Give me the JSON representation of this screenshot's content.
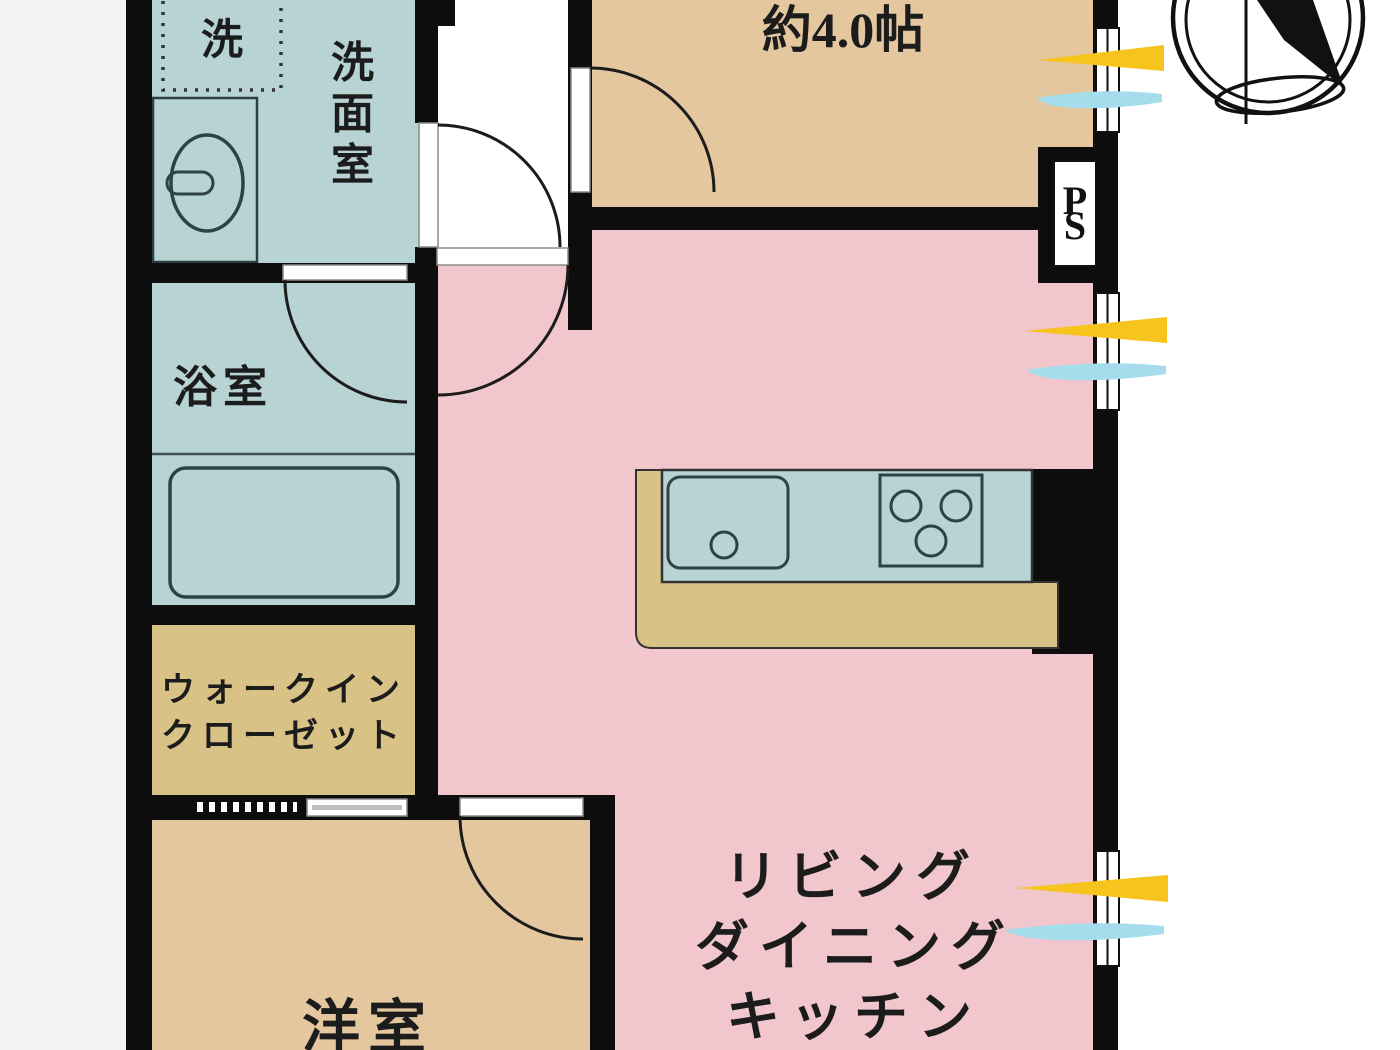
{
  "floor_plan": {
    "rooms": {
      "washroom": {
        "label": "洗面室",
        "washer_label": "洗"
      },
      "bathroom": {
        "label": "浴室"
      },
      "walk_in_closet": {
        "label_line1": "ウォークイン",
        "label_line2": "クローゼット"
      },
      "western_room": {
        "label": "洋室"
      },
      "small_room": {
        "label": "約4.0帖"
      },
      "ldk": {
        "label_line1": "リビング",
        "label_line2": "ダイニング",
        "label_line3": "キッチン"
      }
    },
    "annotations": {
      "pipe_space_top": "P",
      "pipe_space_bottom": "S"
    },
    "colors": {
      "wet_area_blue": "#b7d3d3",
      "ldk_pink": "#f1c6cc",
      "room_tan": "#e4c79f",
      "closet_khaki": "#d9c286",
      "wall_black": "#0d0d0d",
      "sunlight_yellow": "#f6c41d",
      "wind_blue": "#a5dded"
    }
  }
}
